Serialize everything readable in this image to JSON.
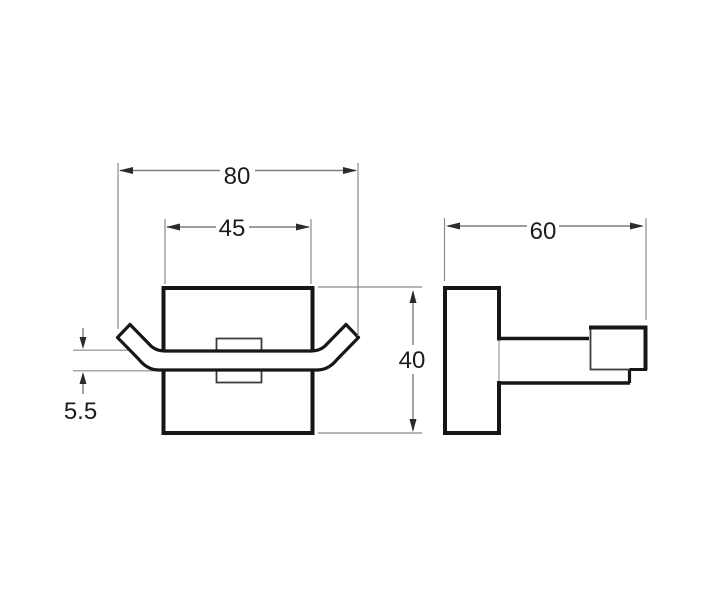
{
  "drawing": {
    "front_view": {
      "label_overall_width": "80",
      "label_plate_width": "45",
      "label_height": "40",
      "label_hook_thickness": "5.5"
    },
    "side_view": {
      "label_depth": "60"
    },
    "colors": {
      "object_line": "#161616",
      "secondary_line": "#3d3d3d",
      "dimension_line": "#7d7d7d",
      "arrow": "#2b2b2b",
      "label_text": "#1b1b22",
      "background": "#ffffff"
    }
  }
}
